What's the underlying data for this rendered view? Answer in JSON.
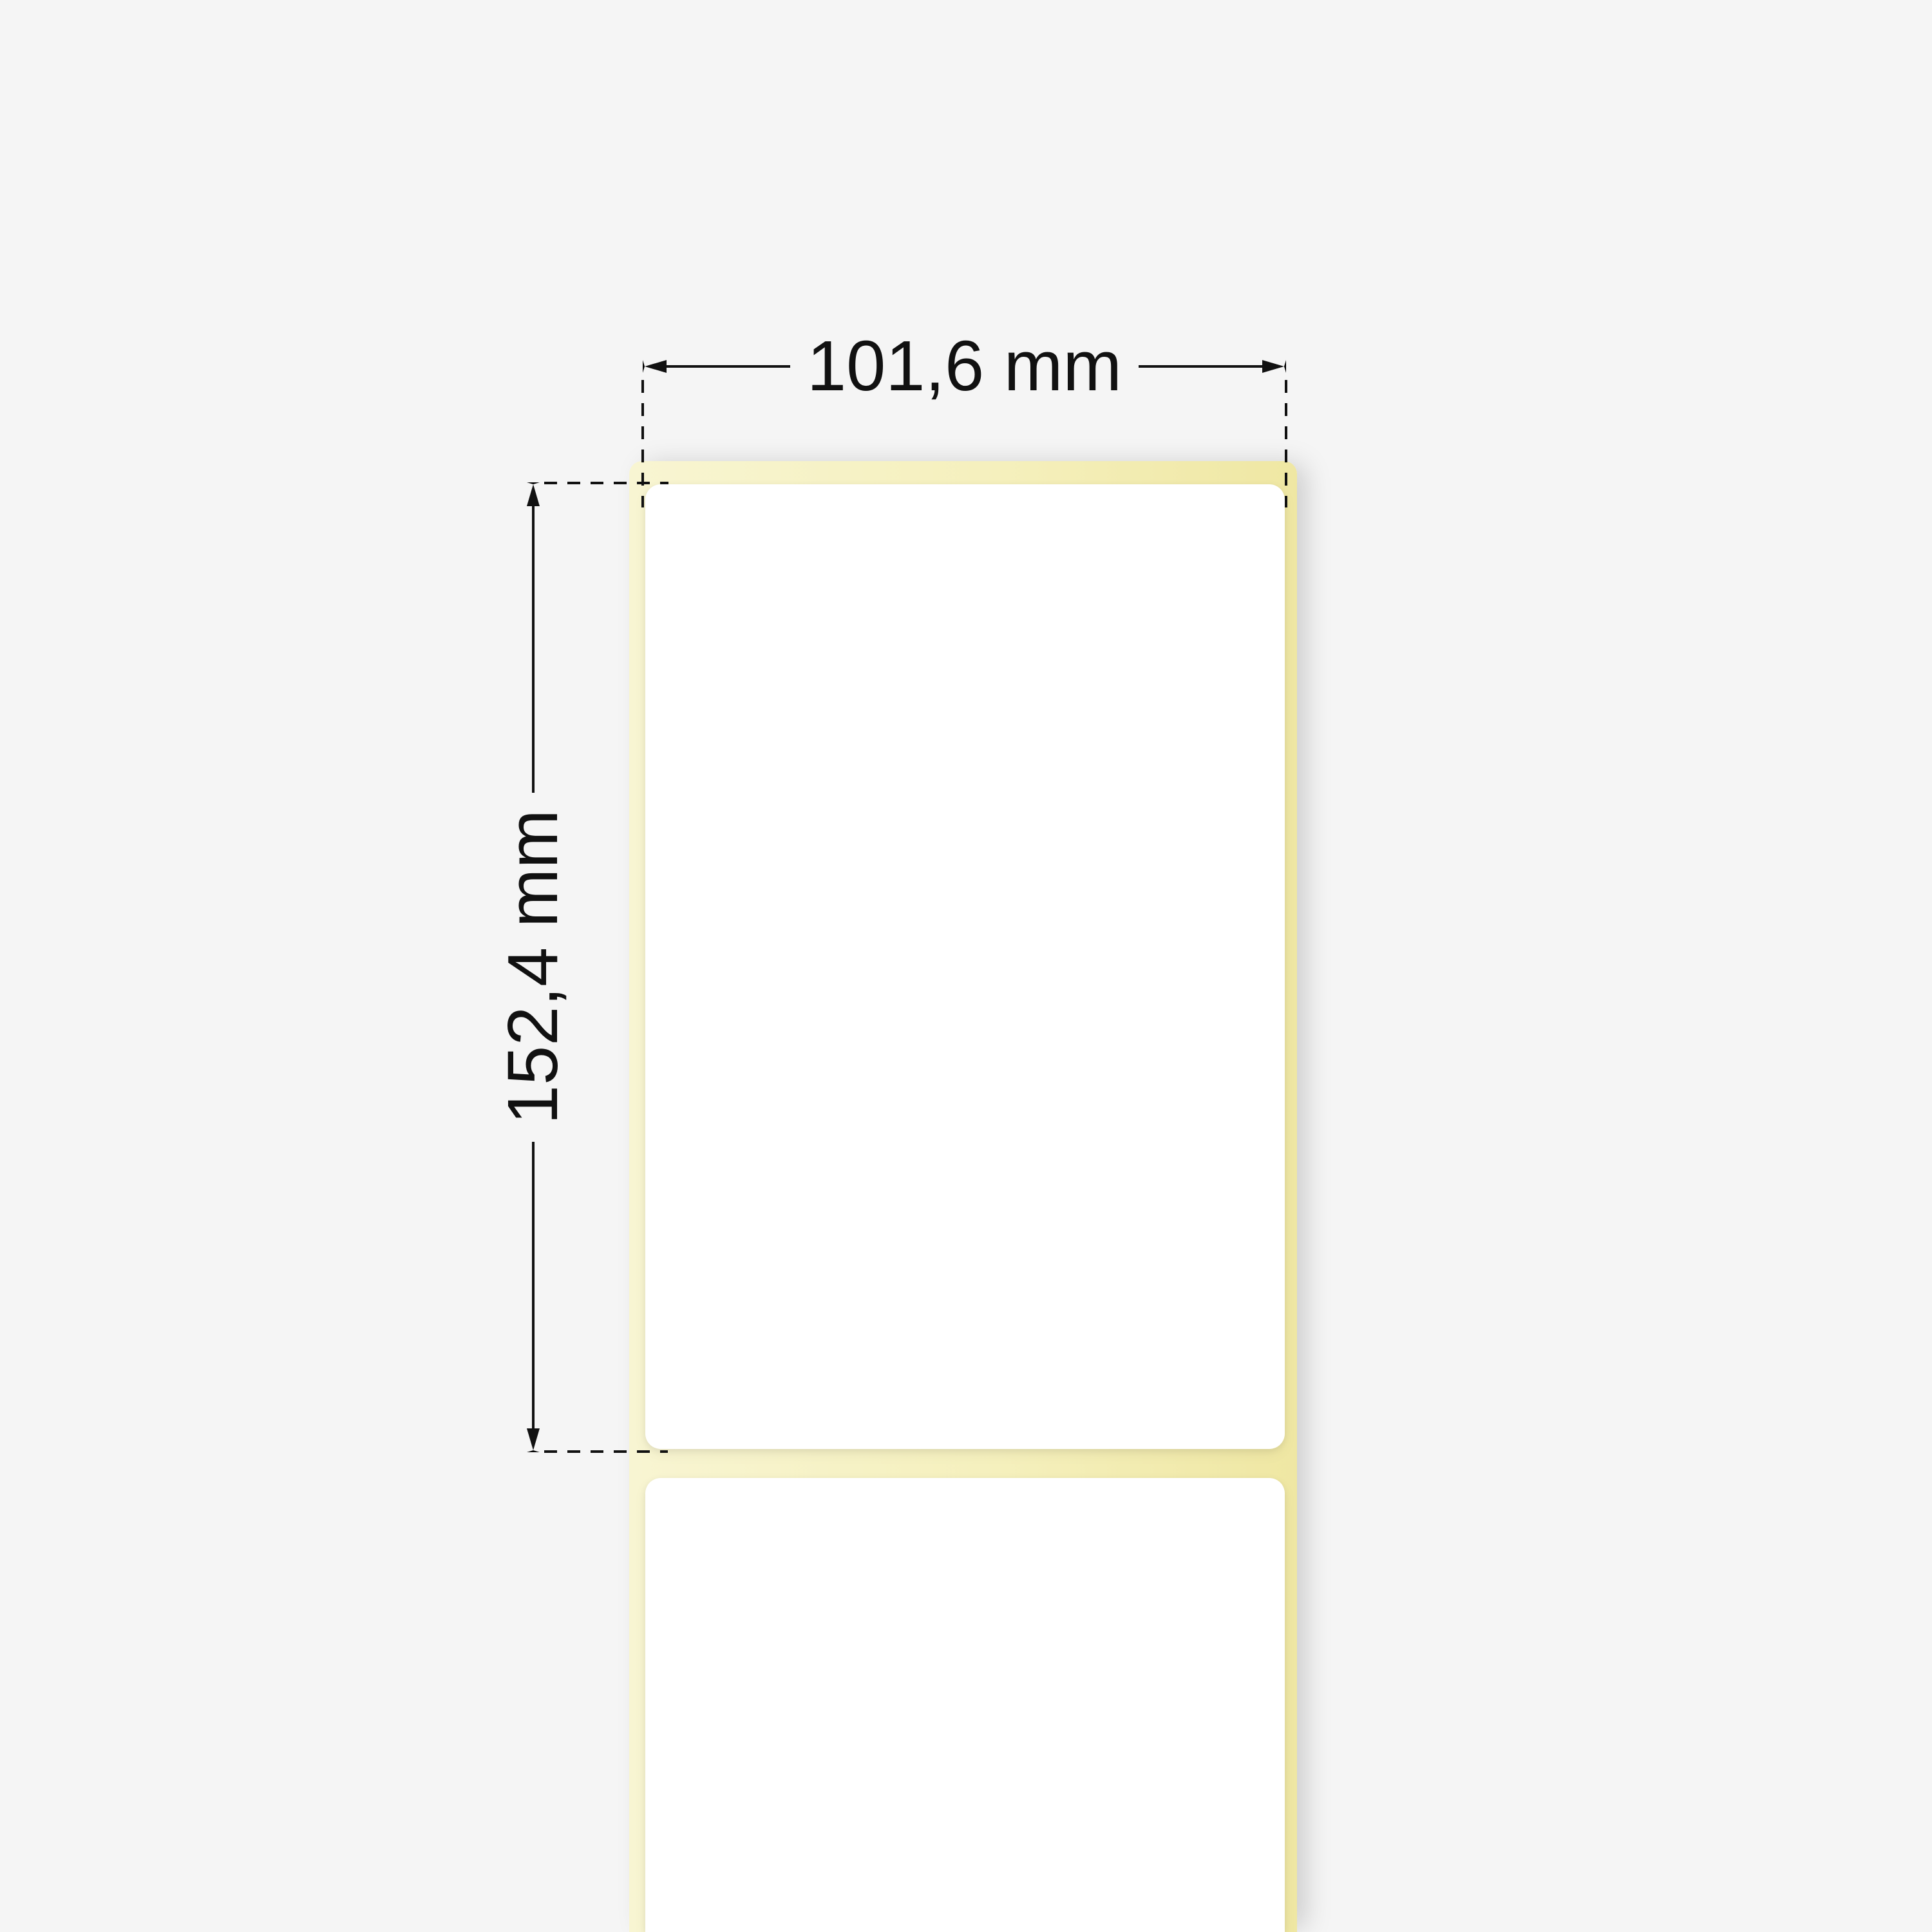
{
  "diagram": {
    "type": "thermal-label-roll-dimension-drawing",
    "dimensions": {
      "width_label": "101,6 mm",
      "height_label": "152,4 mm"
    },
    "colors": {
      "background": "#f5f5f5",
      "liner_yellow": "#f5f0bd",
      "liner_yellow_light": "#f8f5d2",
      "liner_yellow_deep": "#efe7a3",
      "label_white": "#ffffff",
      "line_black": "#111111"
    }
  }
}
